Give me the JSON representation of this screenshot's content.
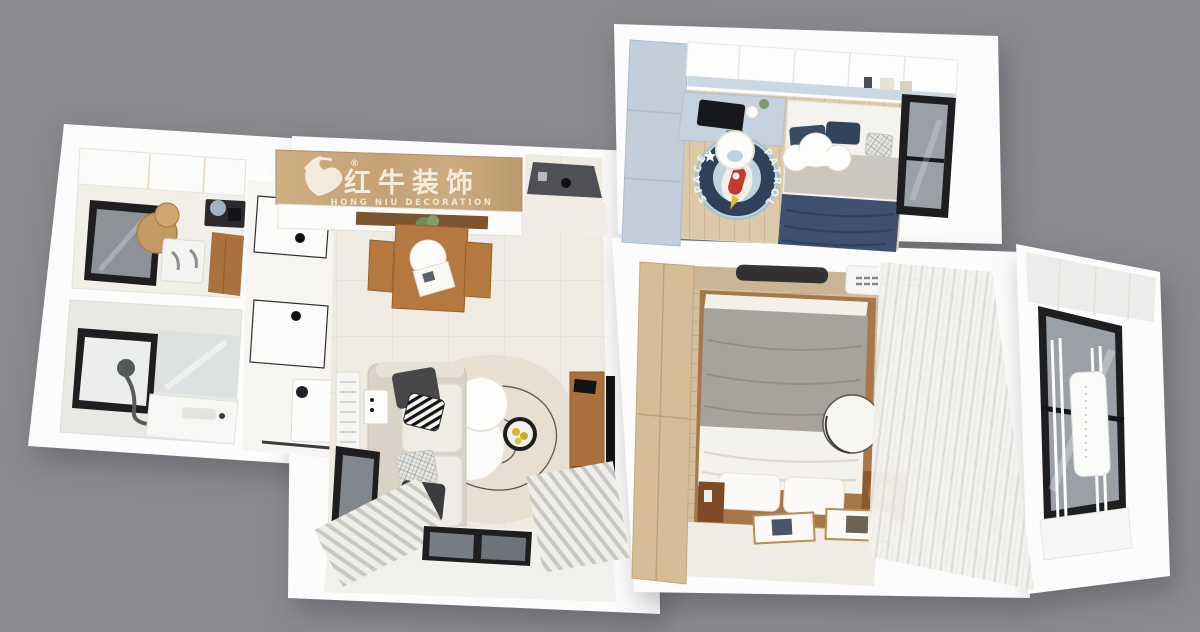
{
  "brand": {
    "logo_cn": "红牛装饰",
    "logo_en": "HONG NIU DECORATION",
    "trademark": "®"
  },
  "kids_room": {
    "rug": {
      "text_top": "SPACE",
      "text_bottom": "PATROL"
    }
  },
  "palette": {
    "background": "#8a8a8f",
    "wall": "#fcfcfc",
    "banner_wood": "#c9a97e",
    "banner_text": "#f3ecdd",
    "table_wood": "#b5793f",
    "cabinet_wood": "#a9713d",
    "wardrobe_oak": "#d6bd96",
    "kids_blue": "#c3cedb",
    "desk_blue": "#c5d1dd",
    "navy": "#3f5070",
    "rug_blue": "#bfd2de",
    "rug_ring": "#2f4158",
    "rocket_red": "#c23a2c",
    "floor_tile": "#efebe2",
    "floor_wood_kids": "#dbc9a9",
    "floor_wood_master": "#d2bf9f",
    "glass": "#9aa0a6",
    "frame_black": "#1e1e21",
    "sofa_beige": "#d9d3c7",
    "blanket_gray": "#a7a29a",
    "curtain": "#f2f1ee",
    "lamp_orange": "#e07a35",
    "entry_door_gray": "#4e5053"
  }
}
